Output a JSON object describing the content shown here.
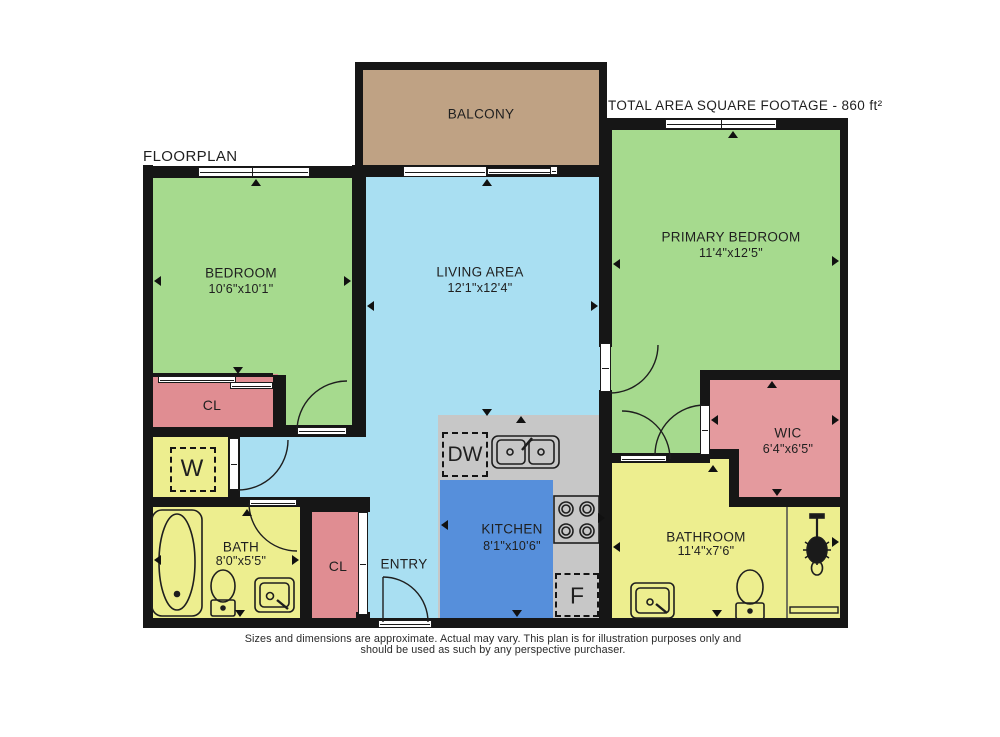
{
  "header": {
    "title": "FLOORPLAN",
    "total_area": "TOTAL AREA SQUARE FOOTAGE - 860 ft²"
  },
  "rooms": {
    "balcony": {
      "name": "BALCONY"
    },
    "bedroom": {
      "name": "BEDROOM",
      "dims": "10'6\"x10'1\""
    },
    "living_area": {
      "name": "LIVING AREA",
      "dims": "12'1\"x12'4\""
    },
    "primary_bedroom": {
      "name": "PRIMARY BEDROOM",
      "dims": "11'4\"x12'5\""
    },
    "wic": {
      "name": "WIC",
      "dims": "6'4\"x6'5\""
    },
    "kitchen": {
      "name": "KITCHEN",
      "dims": "8'1\"x10'6\""
    },
    "bath": {
      "name": "BATH",
      "dims": "8'0\"x5'5\""
    },
    "bathroom": {
      "name": "BATHROOM",
      "dims": "11'4\"x7'6\""
    },
    "bedroom_closet": {
      "name": "CL"
    },
    "entry_closet": {
      "name": "CL"
    },
    "entry": {
      "name": "ENTRY"
    }
  },
  "appliances": {
    "washer": "W",
    "dishwasher": "DW",
    "refrigerator": "F"
  },
  "disclaimer": {
    "line1": "Sizes and dimensions are approximate. Actual may vary. This plan is for illustration purposes only and",
    "line2": "should be used as such by any perspective purchaser."
  },
  "colors": {
    "wall": "#161616",
    "bedroom_green": "#a6da8e",
    "living_blue": "#a9dff2",
    "kitchen_floor_blue": "#568fdb",
    "counter_gray": "#c7c7c7",
    "closet_pink": "#e08d92",
    "wic_pink": "#e49a9e",
    "bath_yellow": "#edee8f",
    "balcony_brown": "#bfa284",
    "door_white": "#ffffff",
    "text_dark": "#222222"
  }
}
